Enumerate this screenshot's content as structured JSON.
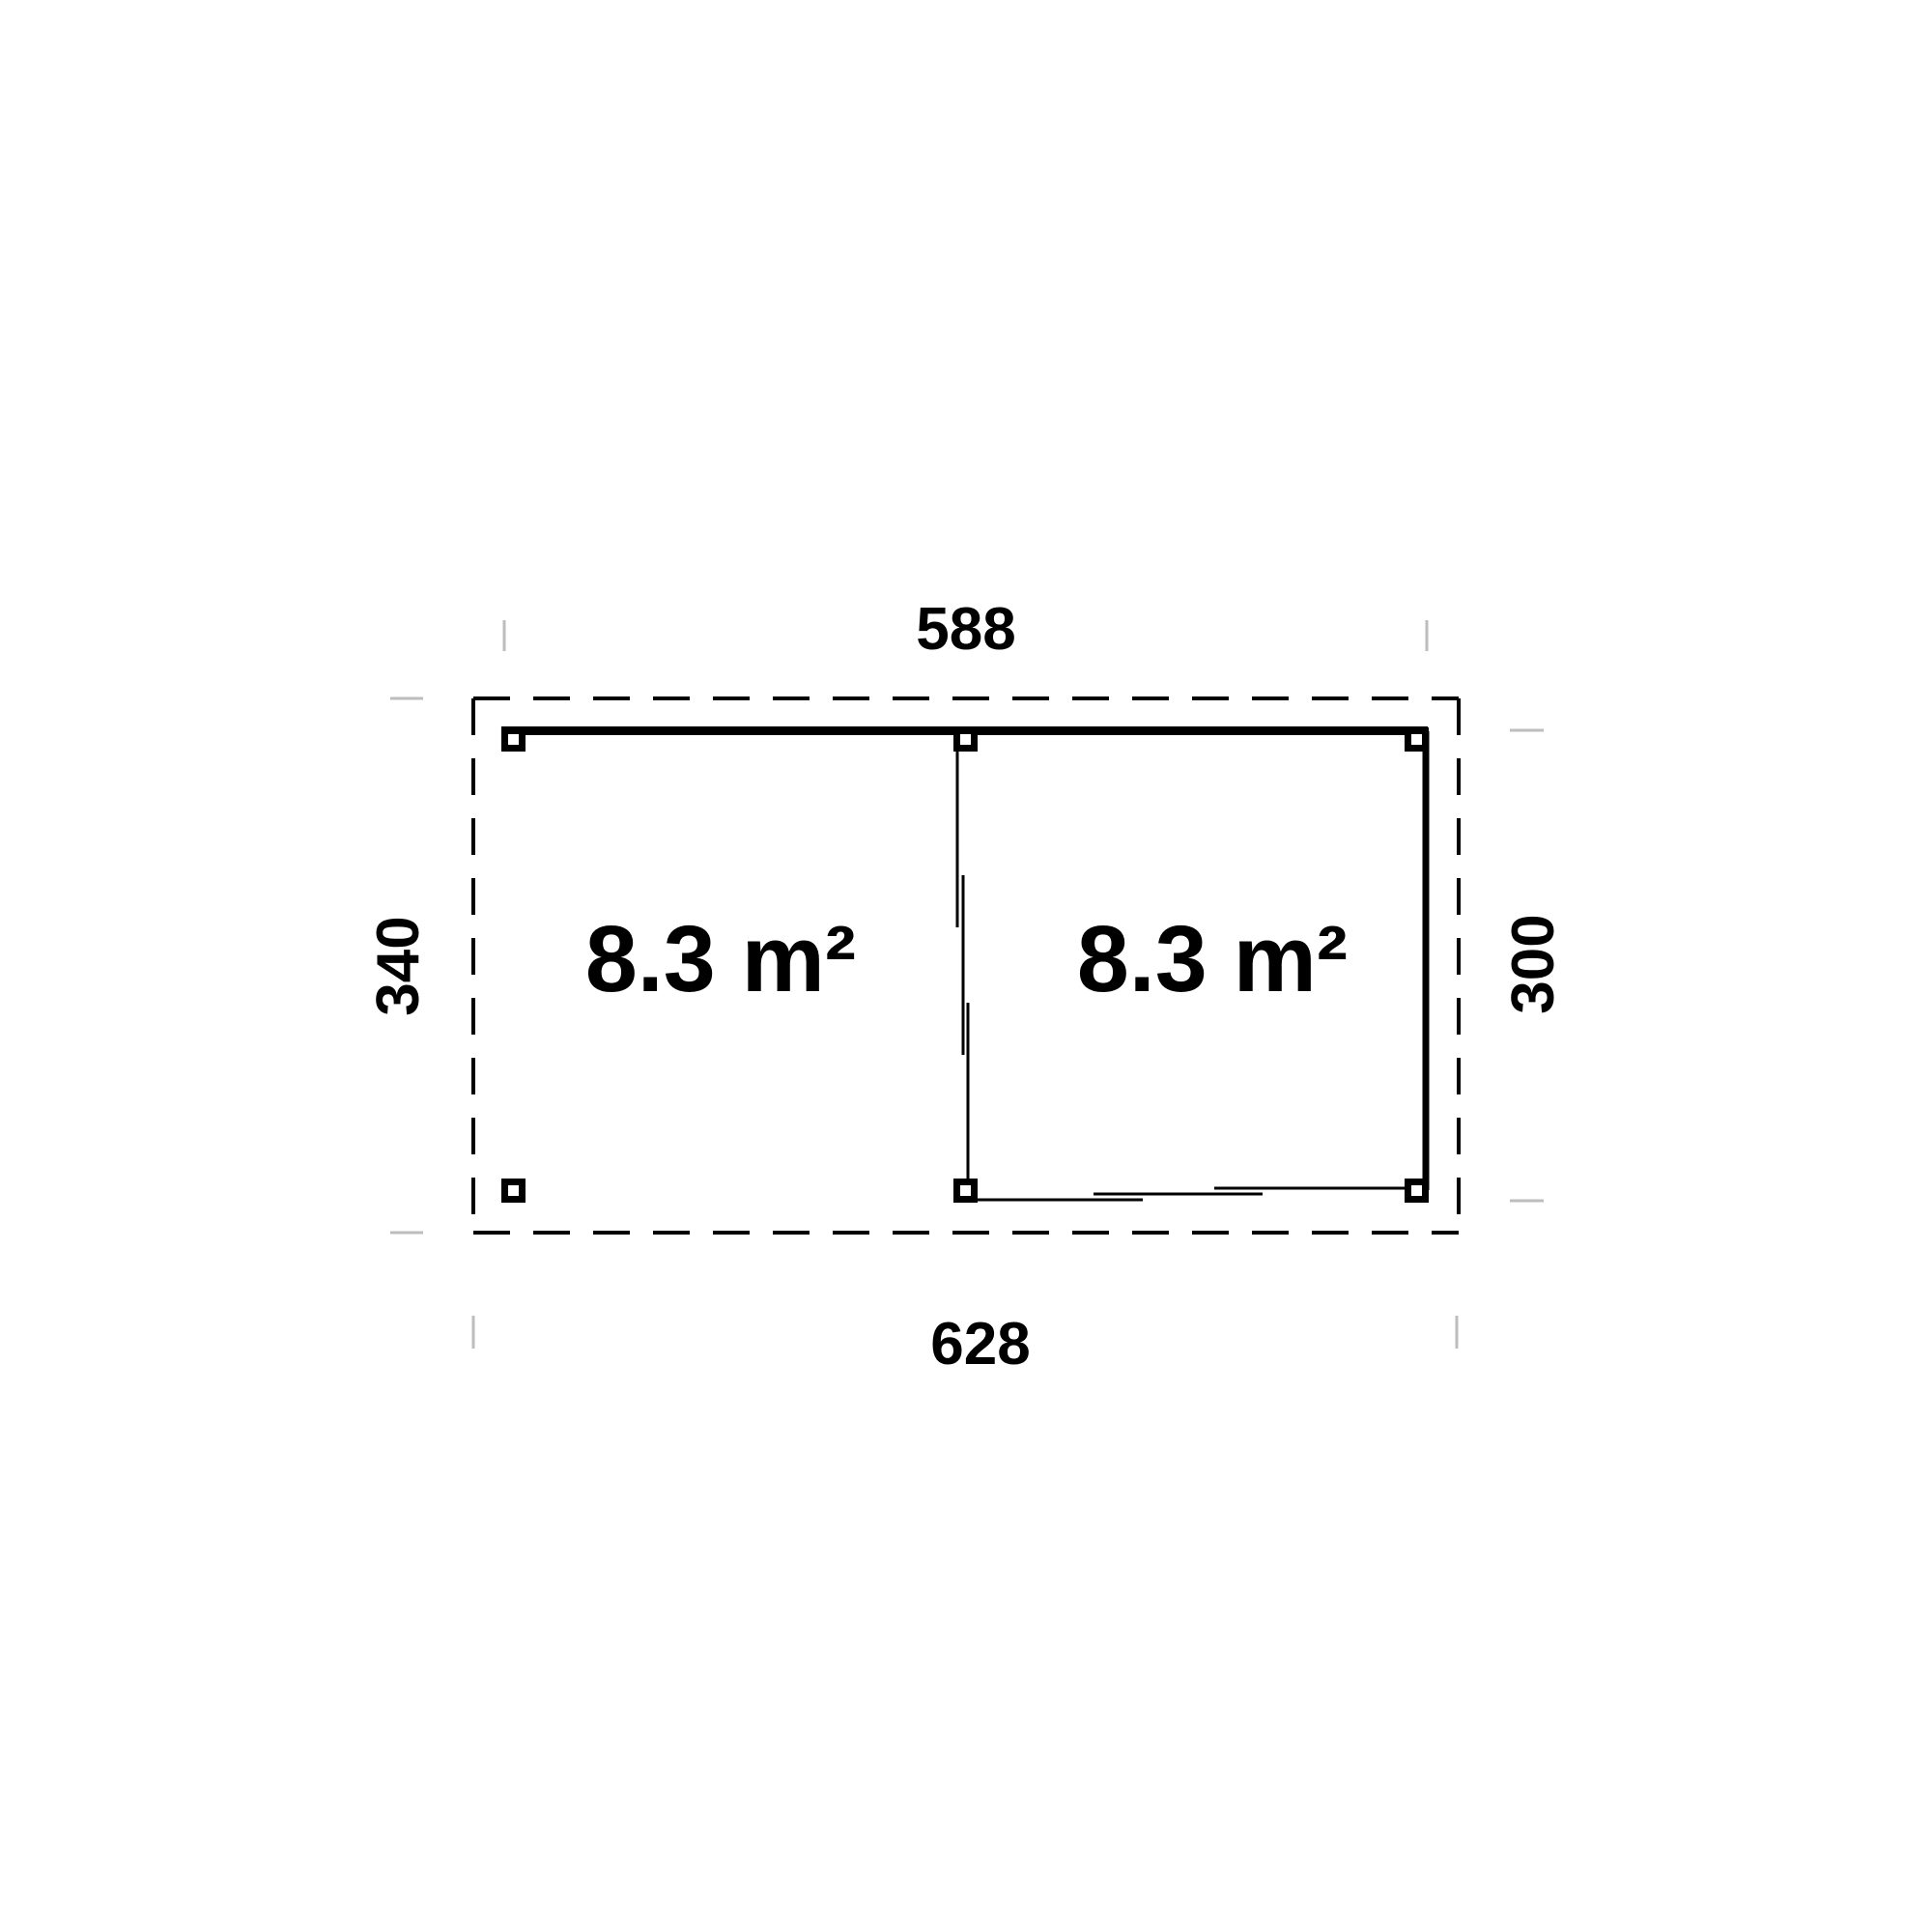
{
  "plan": {
    "type": "floor-plan",
    "rooms": [
      {
        "id": "left-open-section",
        "area_label": "8.3 m²"
      },
      {
        "id": "right-closed-section",
        "area_label": "8.3 m²"
      }
    ],
    "dimensions": {
      "top": "588",
      "bottom": "628",
      "left": "340",
      "right": "300"
    },
    "colors": {
      "line": "#000000",
      "text": "#000000",
      "tick": "#bdbdbd",
      "background": "#ffffff",
      "post_fill": "#ffffff"
    }
  }
}
